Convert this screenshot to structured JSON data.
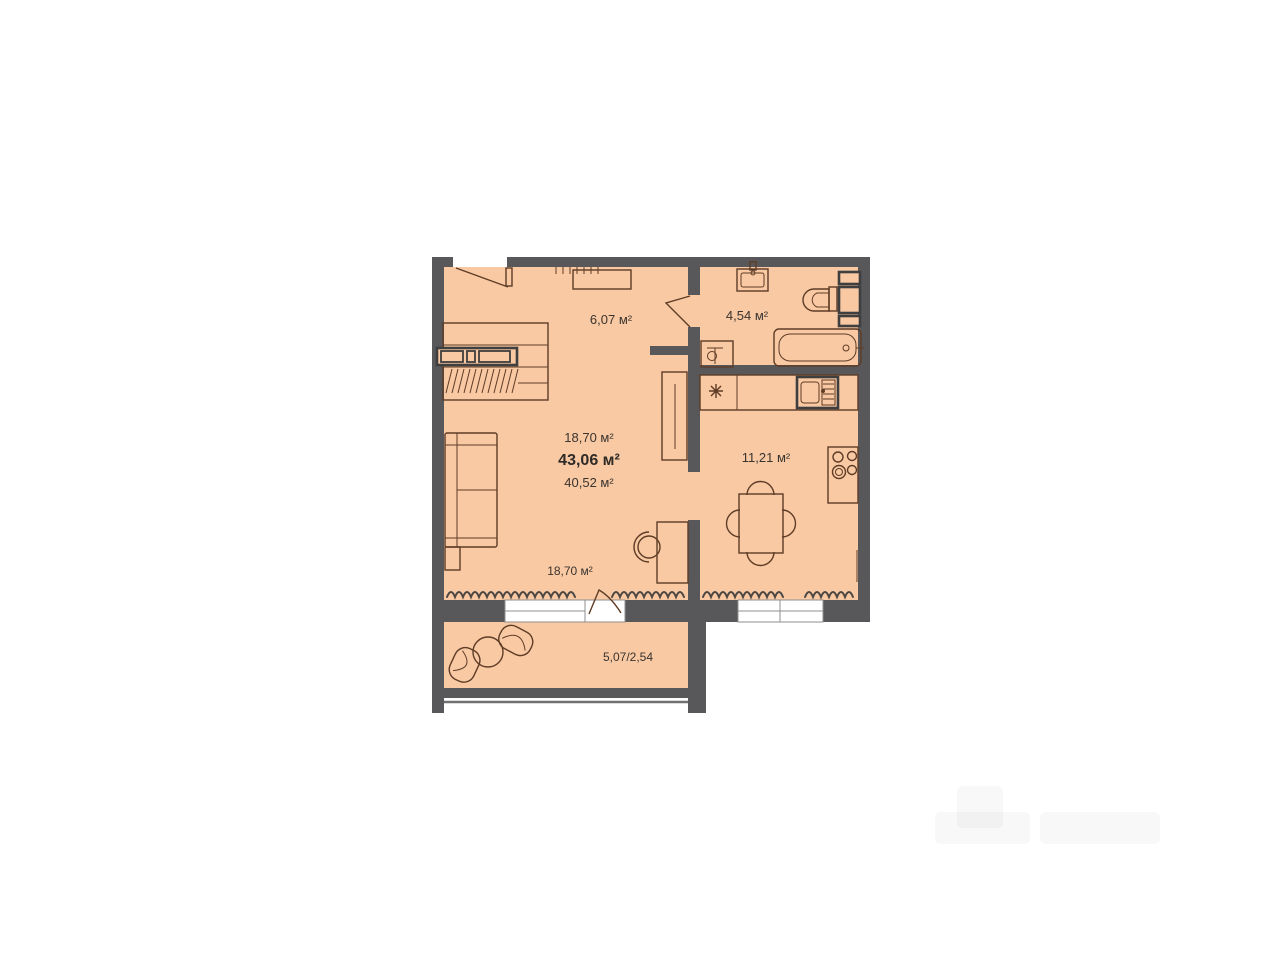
{
  "floorplan": {
    "type": "apartment-floor-plan",
    "labels": {
      "hallway": "6,07 м²",
      "bathroom": "4,54 м²",
      "living_room": "18,70 м²",
      "total_area": "43,06 м²",
      "usable_area": "40,52 м²",
      "kitchen": "11,21 м²",
      "living_room_bottom": "18,70 м²",
      "balcony": "5,07/2,54"
    },
    "colors": {
      "floor": "#f8c9a3",
      "walls": "#58585a",
      "furniture_outline": "#5e3c26",
      "text": "#3a342f"
    }
  }
}
